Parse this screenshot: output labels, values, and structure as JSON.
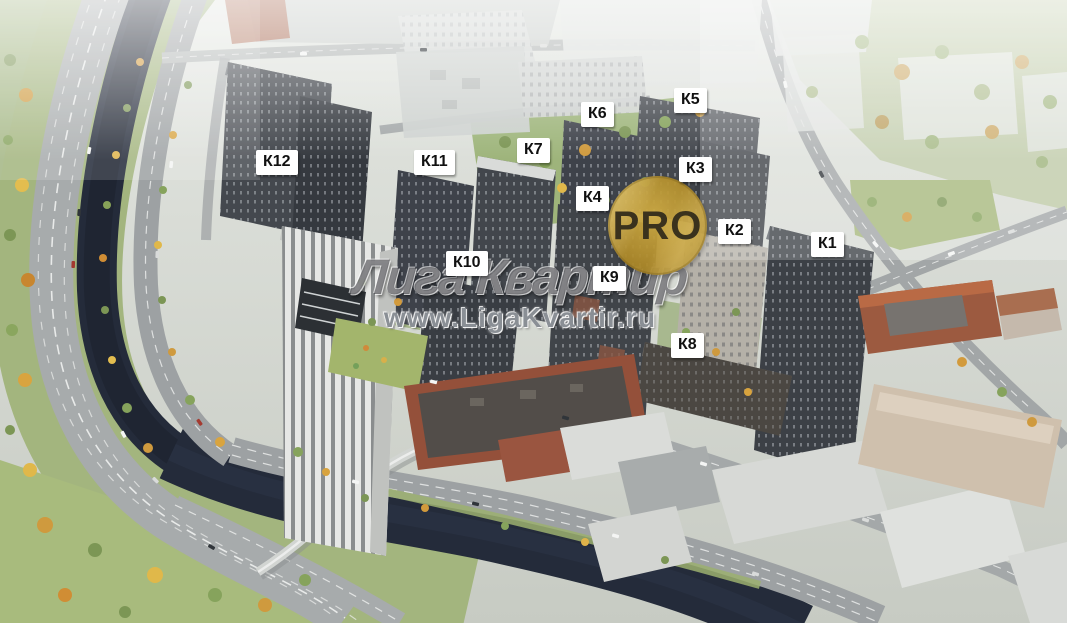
{
  "watermark": {
    "brand_text": "Лига Квартир",
    "site_url": "www.LigaKvartir.ru"
  },
  "badge": {
    "label": "PRO"
  },
  "buildings": [
    {
      "label": "К1",
      "left": 811,
      "top": 232
    },
    {
      "label": "К2",
      "left": 718,
      "top": 219
    },
    {
      "label": "К3",
      "left": 679,
      "top": 157
    },
    {
      "label": "К4",
      "left": 576,
      "top": 186
    },
    {
      "label": "К5",
      "left": 674,
      "top": 88
    },
    {
      "label": "К6",
      "left": 581,
      "top": 102
    },
    {
      "label": "К7",
      "left": 517,
      "top": 138
    },
    {
      "label": "К8",
      "left": 671,
      "top": 333
    },
    {
      "label": "К9",
      "left": 593,
      "top": 266
    },
    {
      "label": "К10",
      "left": 446,
      "top": 251
    },
    {
      "label": "К11",
      "left": 414,
      "top": 150
    },
    {
      "label": "К12",
      "left": 256,
      "top": 150
    }
  ],
  "colors": {
    "badge_gold": "#c9a43c",
    "badge_text": "#3a321d",
    "label_background": "#ffffff",
    "label_text": "#111111",
    "river": "#232a38",
    "watermark_gray": "#80858c"
  }
}
